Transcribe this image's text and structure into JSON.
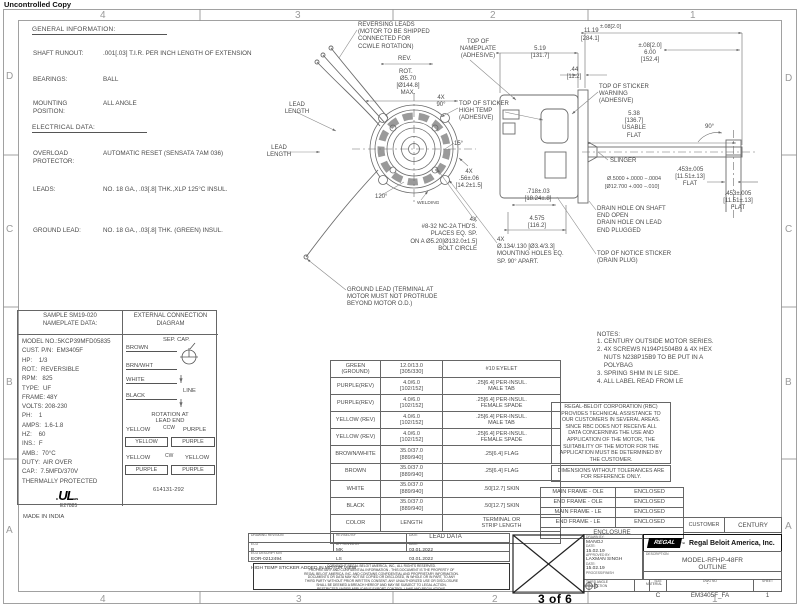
{
  "stamp": "Uncontrolled Copy",
  "page_marker": "3 of 6",
  "zones": {
    "top": [
      {
        "t": "4",
        "x": 100
      },
      {
        "t": "3",
        "x": 295
      },
      {
        "t": "2",
        "x": 490
      },
      {
        "t": "1",
        "x": 690
      }
    ],
    "bottom": [
      {
        "t": "4",
        "x": 100
      },
      {
        "t": "3",
        "x": 296
      },
      {
        "t": "2",
        "x": 492
      },
      {
        "t": "1",
        "x": 712
      }
    ],
    "left": [
      {
        "t": "D",
        "y": 71
      },
      {
        "t": "C",
        "y": 224
      },
      {
        "t": "B",
        "y": 377
      },
      {
        "t": "A",
        "y": 525
      }
    ],
    "right": [
      {
        "t": "D",
        "y": 73
      },
      {
        "t": "C",
        "y": 224
      },
      {
        "t": "B",
        "y": 377
      },
      {
        "t": "A",
        "y": 521
      }
    ]
  },
  "general_info": {
    "title": "GENERAL INFORMATION:",
    "electrical_title": "ELECTRICAL DATA:",
    "rows": [
      {
        "y": 50,
        "label": "SHAFT RUNOUT:",
        "value": ".001[.03] T.I.R. PER INCH LENGTH OF EXTENSION"
      },
      {
        "y": 76,
        "label": "BEARINGS:",
        "value": "BALL"
      },
      {
        "y": 100,
        "label": "MOUNTING\nPOSITION:",
        "value": "ALL ANGLE"
      },
      {
        "y": 150,
        "label": "OVERLOAD\nPROTECTOR:",
        "value": "AUTOMATIC RESET (SENSATA 7AM 036)"
      },
      {
        "y": 186,
        "label": "LEADS:",
        "value": "NO. 18 GA., .03[.8] THK.,XLP 125°C INSUL."
      },
      {
        "y": 227,
        "label": "GROUND LEAD:",
        "value": "NO. 18 GA., .03[.8] THK. (GREEN) INSUL."
      }
    ]
  },
  "nameplate": {
    "header1": "SAMPLE SM19-020",
    "header2": "NAMEPLATE DATA:",
    "lines": [
      "MODEL NO.:5KCP39MFD05835",
      "CUST. P/N:  EM3405F",
      "HP:    1/3",
      "ROT.:  REVERSIBLE",
      "RPM:   825",
      "TYPE:  UF",
      "FRAME: 48Y",
      "VOLTS: 208-230",
      "PH:    1",
      "AMPS:  1.6-1.8",
      "HZ:    60",
      "INS.:  F",
      "AMB.:  70°C",
      "DUTY:  AIR OVER",
      "CAP.:  7.5MFD/370V",
      "THERMALLY PROTECTED"
    ],
    "ul_mark": "UL",
    "ul_c": "c",
    "ul_us": "us",
    "ul_file": "E27885",
    "origin": "MADE IN INDIA"
  },
  "connection": {
    "header1": "EXTERNAL CONNECTION",
    "header2": "DIAGRAM",
    "sep_cap": "SEP. CAP.",
    "wires": [
      "BROWN",
      "BRN/WHT",
      "WHITE",
      "BLACK"
    ],
    "line_label": "LINE",
    "rotation1": "ROTATION AT",
    "rotation2": "LEAD END",
    "ccw_label": "CCW",
    "ccw_top_left": "YELLOW",
    "ccw_top_right": "PURPLE",
    "ccw_box_left": "YELLOW",
    "ccw_box_right": "PURPLE",
    "cw_label": "CW",
    "cw_top_left": "YELLOW",
    "cw_top_right": "YELLOW",
    "cw_box_left": "PURPLE",
    "cw_box_right": "PURPLE",
    "part_no": "614131-292"
  },
  "lead_table": {
    "caption": "LEAD DATA",
    "rows": [
      {
        "c": "GREEN\n(GROUND)",
        "l": "12.0/13.0\n[305/330]",
        "t": "#10 EYELET"
      },
      {
        "c": "PURPLE(REV)",
        "l": "4.0/6.0\n[102/152]",
        "t": ".25[6.4] PER-INSUL.\nMALE TAB"
      },
      {
        "c": "PURPLE(REV)",
        "l": "4.0/6.0\n[102/152]",
        "t": ".25[6.4] PER-INSUL.\nFEMALE SPADE"
      },
      {
        "c": "YELLOW (REV)",
        "l": "4.0/6.0\n[102/152]",
        "t": ".25[6.4] PER-INSUL.\nMALE TAB"
      },
      {
        "c": "YELLOW (REV)",
        "l": "4.0/6.0\n[102/152]",
        "t": ".25[6.4] PER-INSUL.\nFEMALE SPADE"
      },
      {
        "c": "BROWN/WHITE",
        "l": "35.0/37.0\n[889/940]",
        "t": ".25[6.4] FLAG"
      },
      {
        "c": "BROWN",
        "l": "35.0/37.0\n[889/940]",
        "t": ".25[6.4] FLAG"
      },
      {
        "c": "WHITE",
        "l": "35.0/37.0\n[889/940]",
        "t": ".50[12.7] SKIN"
      },
      {
        "c": "BLACK",
        "l": "35.0/37.0\n[889/940]",
        "t": ".50[12.7] SKIN"
      },
      {
        "c": "COLOR",
        "l": "LENGTH",
        "t": "TERMINAL OR\nSTRIP LENGTH"
      }
    ]
  },
  "notes": {
    "title": "NOTES:",
    "lines": [
      "1. CENTURY OUTSIDE MOTOR SERIES.",
      "2. 4X SCREWS N194P1504B9 & 4X HEX",
      "    NUTS N238P15B9 TO BE PUT IN A",
      "    POLYBAG",
      "3. SPRING SHIM IN LE SIDE.",
      "4. ALL LABEL READ FROM LE"
    ]
  },
  "disclaimer": [
    "REGAL-BELOIT CORPORATION (RBC)",
    "PROVIDES TECHNICAL ASSISTANCE TO",
    "OUR CUSTOMERS IN SEVERAL AREAS.",
    "SINCE RBC DOES NOT RECEIVE ALL",
    "DATA CONCERNING THE USE AND",
    "APPLICATION OF THE MOTOR, THE",
    "SUITABILITY OF THE MOTOR FOR THE",
    "APPLICATION MUST BE DETERMINED BY",
    "THE CUSTOMER."
  ],
  "dims_note": [
    "DIMENSIONS WITHOUT TOLERANCES ARE",
    "FOR REFERENCE ONLY."
  ],
  "enclosure": {
    "rows": [
      {
        "f": "MAIN FRAME - OLE",
        "v": "ENCLOSED"
      },
      {
        "f": "END FRAME - OLE",
        "v": "ENCLOSED"
      },
      {
        "f": "MAIN FRAME - LE",
        "v": "ENCLOSED"
      },
      {
        "f": "END FRAME - LE",
        "v": "ENCLOSED"
      }
    ],
    "footer": "ENCLOSURE"
  },
  "customer": {
    "label": "CUSTOMER",
    "value": "CENTURY"
  },
  "logo": {
    "badge": "REGAL",
    "tm": "™",
    "text": "Regal Beloit America, Inc."
  },
  "title_block": {
    "drawn_label": "DRAWN BY:",
    "drawn": "MANOJ",
    "date1_label": "DATE:",
    "date1": "15.02.19",
    "approved_label": "APPROVED BY:",
    "approved": "LAXMAN SINGH",
    "date2_label": "DATE:",
    "date2": "15.02.19",
    "process_label": "PROCESS/FINISH",
    "desc_label": "DESCRIPTION",
    "desc1": "MODEL-RFHP-48FR",
    "desc2": "OUTLINE",
    "material_label": "MATERIAL",
    "material": "-",
    "third_angle": "THIRD ANGLE\nPROJECTION",
    "size_label": "SIZE",
    "size": "C",
    "dwg_label": "DWG NO",
    "dwg": "EM3405F_FA",
    "sheet_label": "SHEET",
    "sheet": "1"
  },
  "revision": {
    "r1l1": "DRAWING REVISION",
    "r1v1": "B",
    "r1l2": "REVISED BY",
    "r1v2": "MK",
    "r1l3": "DATE",
    "r1v3": "03.01.2022",
    "r2l1": "ECO",
    "r2v1": "EOR-0212494",
    "r2l2": "APPROVED BY",
    "r2v2": "LS",
    "r2l3": "DATE",
    "r2v3": "03.01.2022",
    "r3l": "ECO DESCRIPTION",
    "r3v": "HIGH TEMP STICKER ADDED IN MOTOR VIEW"
  },
  "fineprint": [
    "COPYRIGHT REGAL BELOIT AMERICA, INC., ALL RIGHTS RESERVED.",
    "PROPRIETARY AND CONFIDENTIAL INFORMATION - THIS DOCUMENT IS THE PROPERTY OF",
    "REGAL BELOIT AMERICA, INC. AND CONTAINS CONFIDENTIAL AND PROPRIETARY INFORMATION.",
    "DOCUMENTS OR DATA MAY NOT BE COPIED OR DISCLOSED, IN WHOLE OR IN PART, TO ANY",
    "THIRD PARTY WITHOUT PRIOR WRITTEN CONSENT. ANY UNAUTHORIZED USE OR DISCLOSURE",
    "SHALL BE DEEMED A BREACH HEREOF AND MAY BE SUBJECT TO LEGAL ACTION.",
    "RESTRICTED UNDER APPLICABLE EXPORT CONTROL LAWS AND REGULATIONS."
  ],
  "drawing": {
    "annotations": [
      {
        "t": "REVERSING LEADS\n(MOTOR TO BE SHIPPED\nCONNECTED FOR\nCCWLE ROTATION)",
        "x": 358,
        "y": 22
      },
      {
        "t": "REV.",
        "x": 398,
        "y": 56
      },
      {
        "t": "ROT.",
        "x": 399,
        "y": 69
      },
      {
        "t": "Ø5.70\n[Ø144.8]\nMAX.",
        "x": 408,
        "y": 76,
        "a": "c"
      },
      {
        "t": "TOP OF\nNAMEPLATE\n(ADHESIVE)",
        "x": 478,
        "y": 39,
        "a": "c"
      },
      {
        "t": "4X\n90°",
        "x": 441,
        "y": 95,
        "a": "c"
      },
      {
        "t": "TOP OF STICKER\nHIGH TEMP\n(ADHESIVE)",
        "x": 459,
        "y": 101
      },
      {
        "t": "15°",
        "x": 454,
        "y": 141
      },
      {
        "t": "4X\n.56±.06\n[14.2±1.5]",
        "x": 469,
        "y": 169,
        "a": "c"
      },
      {
        "t": "LEAD\nLENGTH",
        "x": 297,
        "y": 102,
        "a": "c"
      },
      {
        "t": "LEAD\nLENGTH",
        "x": 279,
        "y": 145,
        "a": "c"
      },
      {
        "t": "120°",
        "x": 375,
        "y": 194
      },
      {
        "t": "WELDING",
        "x": 417,
        "y": 201,
        "f": 4.8
      },
      {
        "t": "GROUND LEAD (TERMINAL AT\nMOTOR MUST NOT PROTRUDE\nBEYOND MOTOR O.D.)",
        "x": 347,
        "y": 287
      },
      {
        "t": "4X\n#8-32 NC-2A THD'S.\nPLACES EQ. SP.\nON A Ø5.20[Ø132.0±1.5]\nBOLT CIRCLE",
        "x": 477,
        "y": 217,
        "a": "r"
      },
      {
        "t": "4X\nØ.134/.130 [Ø3.4/3.3]\nMOUNTING HOLES EQ.\nSP. 90° APART.",
        "x": 497,
        "y": 237
      },
      {
        "t": ".718±.03\n[18.24±.8]",
        "x": 538,
        "y": 189,
        "a": "c"
      },
      {
        "t": "4.575\n[116.2]",
        "x": 537,
        "y": 216,
        "a": "c"
      },
      {
        "t": "11.19",
        "x": 584,
        "y": 28
      },
      {
        "t": "±.08[2.0]",
        "x": 600,
        "y": 24,
        "f": 5.4
      },
      {
        "t": "[284.1]",
        "x": 581,
        "y": 36
      },
      {
        "t": "±.08[2.0]\n6.00\n[152.4]",
        "x": 650,
        "y": 43,
        "a": "c"
      },
      {
        "t": "5.19\n[131.7]",
        "x": 540,
        "y": 46,
        "a": "c"
      },
      {
        "t": ".44\n[11.2]",
        "x": 574,
        "y": 67,
        "a": "c"
      },
      {
        "t": "TOP OF STICKER\nWARNING\n(ADHESIVE)",
        "x": 599,
        "y": 84
      },
      {
        "t": "5.38\n[136.7]\nUSABLE\nFLAT",
        "x": 634,
        "y": 111,
        "a": "c"
      },
      {
        "t": "SLINGER",
        "x": 610,
        "y": 158
      },
      {
        "t": "Ø.5000 +.0000 −.0004",
        "x": 607,
        "y": 176,
        "f": 5.4
      },
      {
        "t": "[Ø12.700 +.000 −.010]",
        "x": 605,
        "y": 184,
        "f": 5.4
      },
      {
        "t": ".453±.005\n[11.51±.13]\nFLAT",
        "x": 690,
        "y": 167,
        "a": "c"
      },
      {
        "t": "90°",
        "x": 705,
        "y": 124
      },
      {
        "t": ".453±.005\n[11.51±.13]\nFLAT",
        "x": 738,
        "y": 191,
        "a": "c"
      },
      {
        "t": "DRAIN HOLE ON SHAFT\nEND OPEN\nDRAIN HOLE ON LEAD\nEND PLUGGED",
        "x": 597,
        "y": 206
      },
      {
        "t": "TOP OF NOTICE STICKER\n(DRAIN PLUG)",
        "x": 597,
        "y": 251
      }
    ]
  }
}
